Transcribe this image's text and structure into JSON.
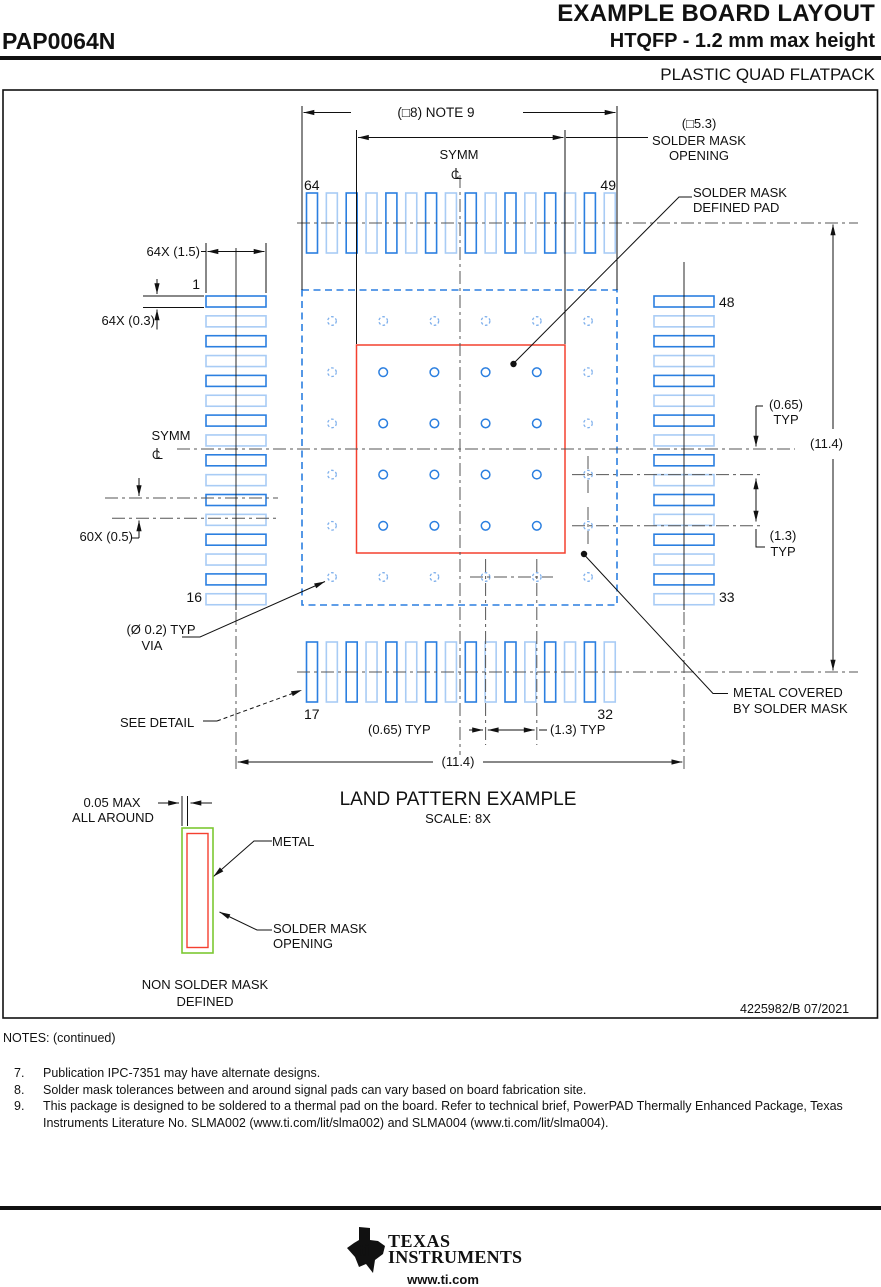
{
  "header": {
    "doc_title": "EXAMPLE BOARD LAYOUT",
    "part_number": "PAP0064N",
    "subtitle": "HTQFP - 1.2 mm max height",
    "package_type": "PLASTIC QUAD FLATPACK"
  },
  "drawing": {
    "dim_overall": "(□8) NOTE 9",
    "smo_dim": "(□5.3)",
    "smo_label_1": "SOLDER MASK",
    "smo_label_2": "OPENING",
    "symm": "SYMM",
    "pins": {
      "p64": "64",
      "p49": "49",
      "p48": "48",
      "p33": "33",
      "p1": "1",
      "p16": "16",
      "p17": "17",
      "p32": "32"
    },
    "dim_pad_len": "64X (1.5)",
    "dim_pad_w": "64X (0.3)",
    "dim_pitch": "60X (0.5)",
    "via_label_1": "(Ø 0.2) TYP",
    "via_label_2": "VIA",
    "see_detail": "SEE DETAIL",
    "dim_065": "(0.65) TYP",
    "dim_13": "(1.3) TYP",
    "dim_065_1": "(0.65)",
    "dim_13_1": "(1.3)",
    "typ": "TYP",
    "dim_body": "(11.4)",
    "smd_label_1": "SOLDER MASK",
    "smd_label_2": "DEFINED PAD",
    "mc_label_1": "METAL COVERED",
    "mc_label_2": "BY SOLDER MASK",
    "title": "LAND PATTERN EXAMPLE",
    "scale": "SCALE: 8X",
    "doc_number": "4225982/B   07/2021",
    "detail": {
      "gap_1": "0.05 MAX",
      "gap_2": "ALL AROUND",
      "metal": "METAL",
      "smo_1": "SOLDER MASK",
      "smo_2": "OPENING",
      "caption_1": "NON SOLDER MASK",
      "caption_2": "DEFINED"
    },
    "pad_count_per_side": 16,
    "via_grid": 6
  },
  "notes": {
    "heading": "NOTES: (continued)",
    "items": [
      {
        "num": "7.",
        "text": "Publication IPC-7351 may have alternate designs."
      },
      {
        "num": "8.",
        "text": "Solder mask tolerances between and around signal pads can vary based on board fabrication site."
      },
      {
        "num": "9.",
        "text": "This package is designed to be soldered to a thermal pad on the board. Refer to technical brief, PowerPAD Thermally Enhanced Package, Texas Instruments Literature No. SLMA002 (www.ti.com/lit/slma002) and SLMA004 (www.ti.com/lit/slma004)."
      }
    ]
  },
  "footer": {
    "brand_1": "TEXAS",
    "brand_2": "INSTRUMENTS",
    "logo_text": "ti",
    "url": "www.ti.com"
  },
  "colors": {
    "pad_dark": "#2b7fe0",
    "pad_light": "#a9ccf5",
    "via": "#2b7fe0",
    "via_masked": "#7fb0ec",
    "mask_outline": "#2b7fe0",
    "metal_red": "#f4402f",
    "mask_green": "#7cc832"
  }
}
